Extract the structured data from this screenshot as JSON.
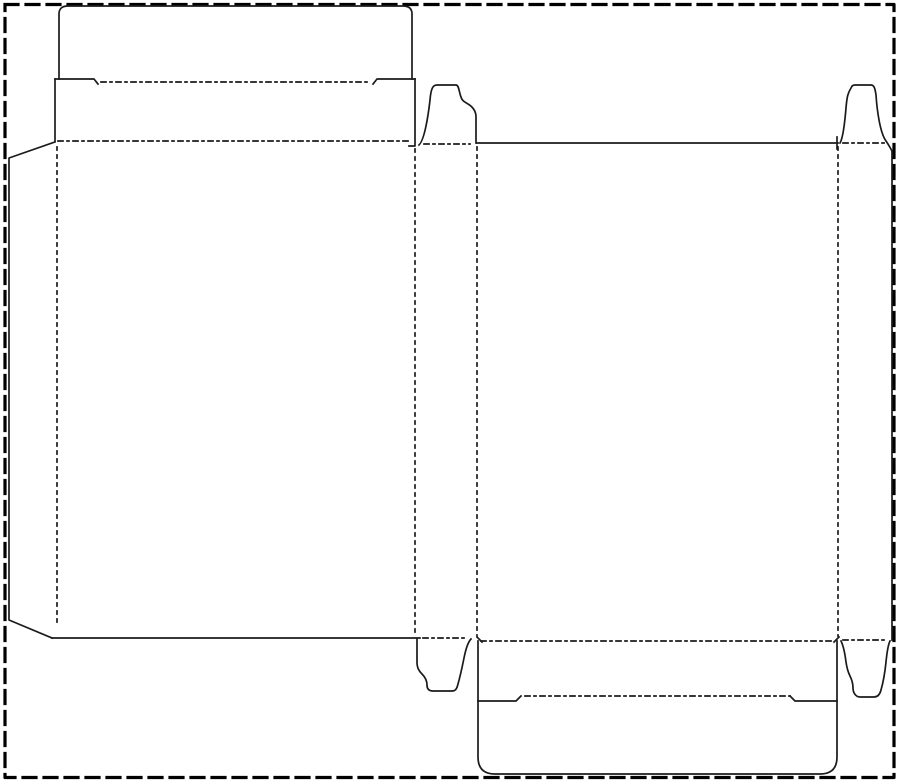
{
  "page": {
    "width": 900,
    "height": 782,
    "background": "#ffffff",
    "line_color": "#1b1b1b",
    "border_color": "#000000",
    "description": "carton box dieline with cut lines (solid) and crease fold lines (dotted)"
  },
  "dieline": {
    "canvas": {
      "width": 900,
      "height": 782
    },
    "styles": {
      "border": {
        "stroke": "#000000",
        "width": 3.2,
        "dash": "13,8"
      },
      "cut": {
        "stroke": "#1b1b1b",
        "width": 1.7,
        "dash": ""
      },
      "creaseV": {
        "stroke": "#1b1b1b",
        "width": 1.7,
        "dash": "3,5"
      },
      "creaseH": {
        "stroke": "#1b1b1b",
        "width": 1.7,
        "dash": "5,4,2,4"
      }
    },
    "elements": [
      {
        "name": "page-border",
        "style": "border",
        "d": "M5,4.5 H894 V777.5 H5 Z"
      },
      {
        "name": "tuck-flap-top-cut",
        "style": "cut",
        "d": "M59,79 L59,14 Q59,6 68,6 L403,6 Q412,6 412,14 L412,79"
      },
      {
        "name": "tuck-flap-shoulder-left-cut",
        "style": "cut",
        "d": "M55,79 L94,79 L98,84"
      },
      {
        "name": "tuck-flap-top-fold",
        "style": "creaseH",
        "d": "M101,82 L368,82"
      },
      {
        "name": "tuck-flap-shoulder-right-cut",
        "style": "cut",
        "d": "M373,84 L377,79 L415,79"
      },
      {
        "name": "lid-panel-left-cut",
        "style": "cut",
        "d": "M55,79 L55,141"
      },
      {
        "name": "lid-panel-right-cut",
        "style": "cut",
        "d": "M415,79 L415,146 L409,146"
      },
      {
        "name": "lid-front-fold",
        "style": "creaseH",
        "d": "M58,141 L412,141"
      },
      {
        "name": "glue-flap-cut",
        "style": "cut",
        "d": "M55,142 L9,158 L9,620 L52,638"
      },
      {
        "name": "front-panel-left-fold",
        "style": "creaseV",
        "d": "M57,147 L57,622"
      },
      {
        "name": "front-panel-right-fold",
        "style": "creaseV",
        "d": "M415,149 L415,636"
      },
      {
        "name": "front-panel-bottom-cut",
        "style": "cut",
        "d": "M52,638 L420,638"
      },
      {
        "name": "dust-flap-top-left-cut",
        "style": "cut",
        "d": "M419,145 C424,141 428,118 430,100 C431,88 433,85 437,85 L456,85 C459,85 459,92 461,97 C462,101 465,102 468,104 C473,107 476,111 476,117 L476,143"
      },
      {
        "name": "dust-flap-top-left-fold",
        "style": "creaseH",
        "d": "M424,144 L470,144"
      },
      {
        "name": "back-panel-left-fold",
        "style": "creaseV",
        "d": "M477,147 L477,636"
      },
      {
        "name": "back-panel-top-cut",
        "style": "cut",
        "d": "M477,143 L838,143"
      },
      {
        "name": "back-panel-top-right-nick",
        "style": "cut",
        "d": "M837,137 L837,149"
      },
      {
        "name": "back-panel-right-fold",
        "style": "creaseV",
        "d": "M838,147 L838,636"
      },
      {
        "name": "dust-flap-top-right-cut",
        "style": "cut",
        "d": "M840,143 C843,138 845,120 846,108 C847,96 848,93 851,88 Q852,85 855,85 L871,85 C874,85 875,88 876,95 C877,110 880,133 886,141 C888,144 890,147 892,151"
      },
      {
        "name": "dust-flap-top-right-fold",
        "style": "creaseH",
        "d": "M843,143 L884,143"
      },
      {
        "name": "side-panel-right-cut",
        "style": "cut",
        "d": "M892,151 L892,640"
      },
      {
        "name": "back-bottom-fold",
        "style": "creaseH",
        "d": "M481,641 L835,641"
      },
      {
        "name": "back-bottom-fold-nick-left",
        "style": "cut",
        "d": "M477,637 L482,642"
      },
      {
        "name": "back-bottom-fold-nick-right",
        "style": "cut",
        "d": "M834,642 L839,637"
      },
      {
        "name": "dust-flap-bottom-left-cut",
        "style": "cut",
        "d": "M417,639 L417,662 C417,668 419,671 422,674 C425,677 427,680 427,685 C427,689 429,691 433,691 L452,691 C456,691 457,688 458,684 C460,677 462,668 464,658 C466,648 468,642 471,639"
      },
      {
        "name": "dust-flap-bottom-left-fold",
        "style": "creaseH",
        "d": "M423,638 L468,638"
      },
      {
        "name": "dust-flap-bottom-right-cut",
        "style": "cut",
        "d": "M841,641 C843,645 845,654 846,662 C847,669 848,672 850,676 C852,680 853,684 853,688 C853,693 856,697 860,697 L874,697 C878,697 880,694 881,690 C883,683 885,672 886,662 C887,652 888,645 890,641"
      },
      {
        "name": "dust-flap-bottom-right-fold",
        "style": "creaseH",
        "d": "M843,640 L886,640"
      },
      {
        "name": "bottom-panel-and-tuck-cut",
        "style": "cut",
        "d": "M478,641 L478,757 Q478,774 495,774 L820,774 Q837,774 837,757 L837,641"
      },
      {
        "name": "bottom-shoulder-left-cut",
        "style": "cut",
        "d": "M478,701 L516,701 L521,696"
      },
      {
        "name": "bottom-tuck-fold",
        "style": "creaseH",
        "d": "M525,696 L790,696"
      },
      {
        "name": "bottom-shoulder-right-cut",
        "style": "cut",
        "d": "M790,696 L795,701 L837,701"
      }
    ]
  }
}
